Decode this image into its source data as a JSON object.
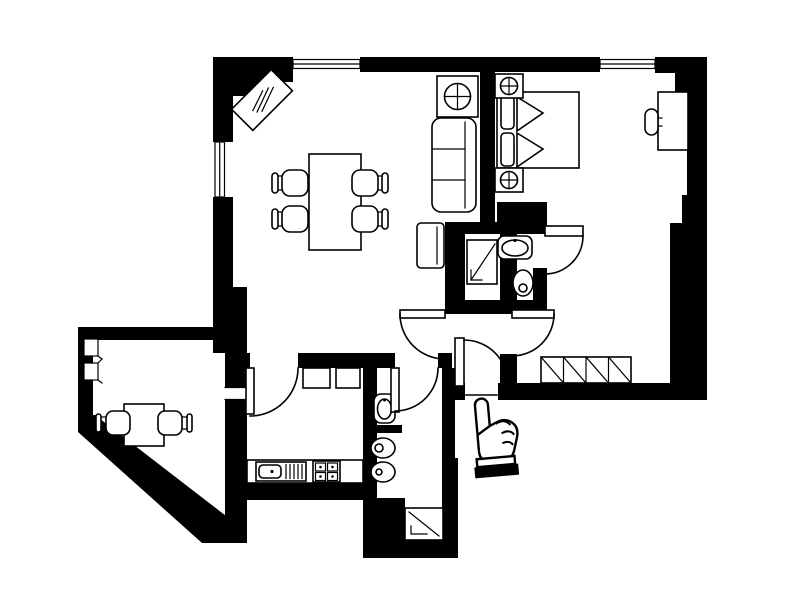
{
  "page": {
    "width": 800,
    "height": 600,
    "colors": {
      "background": "#ffffff",
      "walls": "#000000",
      "lines": "#000000",
      "floor": "#ffffff"
    }
  },
  "diagram": {
    "type": "apartment-floor-plan",
    "rooms": [
      {
        "name": "living-dining-room",
        "furniture": [
          {
            "item": "dining-table"
          },
          {
            "item": "dining-chair",
            "count": 4
          },
          {
            "item": "sofa",
            "cushions": 3
          },
          {
            "item": "side-table-with-lamp"
          },
          {
            "item": "armchair"
          },
          {
            "item": "corner-cabinet",
            "placement": "diagonal"
          }
        ]
      },
      {
        "name": "bedroom",
        "furniture": [
          {
            "item": "double-bed",
            "pillows": 2
          },
          {
            "item": "nightstand-with-lamp",
            "count": 2
          },
          {
            "item": "desk"
          },
          {
            "item": "desk-chair"
          },
          {
            "item": "wardrobe",
            "sections": 4
          }
        ]
      },
      {
        "name": "ensuite-bathroom",
        "furniture": [
          {
            "item": "shower"
          },
          {
            "item": "washbasin"
          },
          {
            "item": "toilet"
          }
        ]
      },
      {
        "name": "kitchen",
        "furniture": [
          {
            "item": "counter"
          },
          {
            "item": "sink-unit"
          },
          {
            "item": "stove",
            "burners": 4
          },
          {
            "item": "wall-cabinet",
            "count": 2
          }
        ]
      },
      {
        "name": "second-bathroom",
        "furniture": [
          {
            "item": "washbasin"
          },
          {
            "item": "toilet"
          },
          {
            "item": "bidet"
          },
          {
            "item": "shower"
          }
        ]
      },
      {
        "name": "hallway",
        "furniture": []
      },
      {
        "name": "balcony",
        "furniture": [
          {
            "item": "table"
          },
          {
            "item": "chair",
            "count": 2
          },
          {
            "item": "plant-box",
            "count": 2
          }
        ]
      }
    ],
    "openings": {
      "windows": [
        {
          "id": "living-room-top-window"
        },
        {
          "id": "living-room-left-window"
        },
        {
          "id": "bedroom-top-window"
        },
        {
          "id": "kitchen-balcony-opening"
        }
      ],
      "doors": [
        {
          "id": "kitchen-door"
        },
        {
          "id": "living-room-door"
        },
        {
          "id": "second-bathroom-door"
        },
        {
          "id": "bedroom-door"
        },
        {
          "id": "ensuite-bathroom-door"
        },
        {
          "id": "entrance-door"
        }
      ]
    },
    "cursor": {
      "icon": "hand-pointer",
      "gesture": "index-finger-up",
      "location": "below-entrance-door"
    }
  }
}
